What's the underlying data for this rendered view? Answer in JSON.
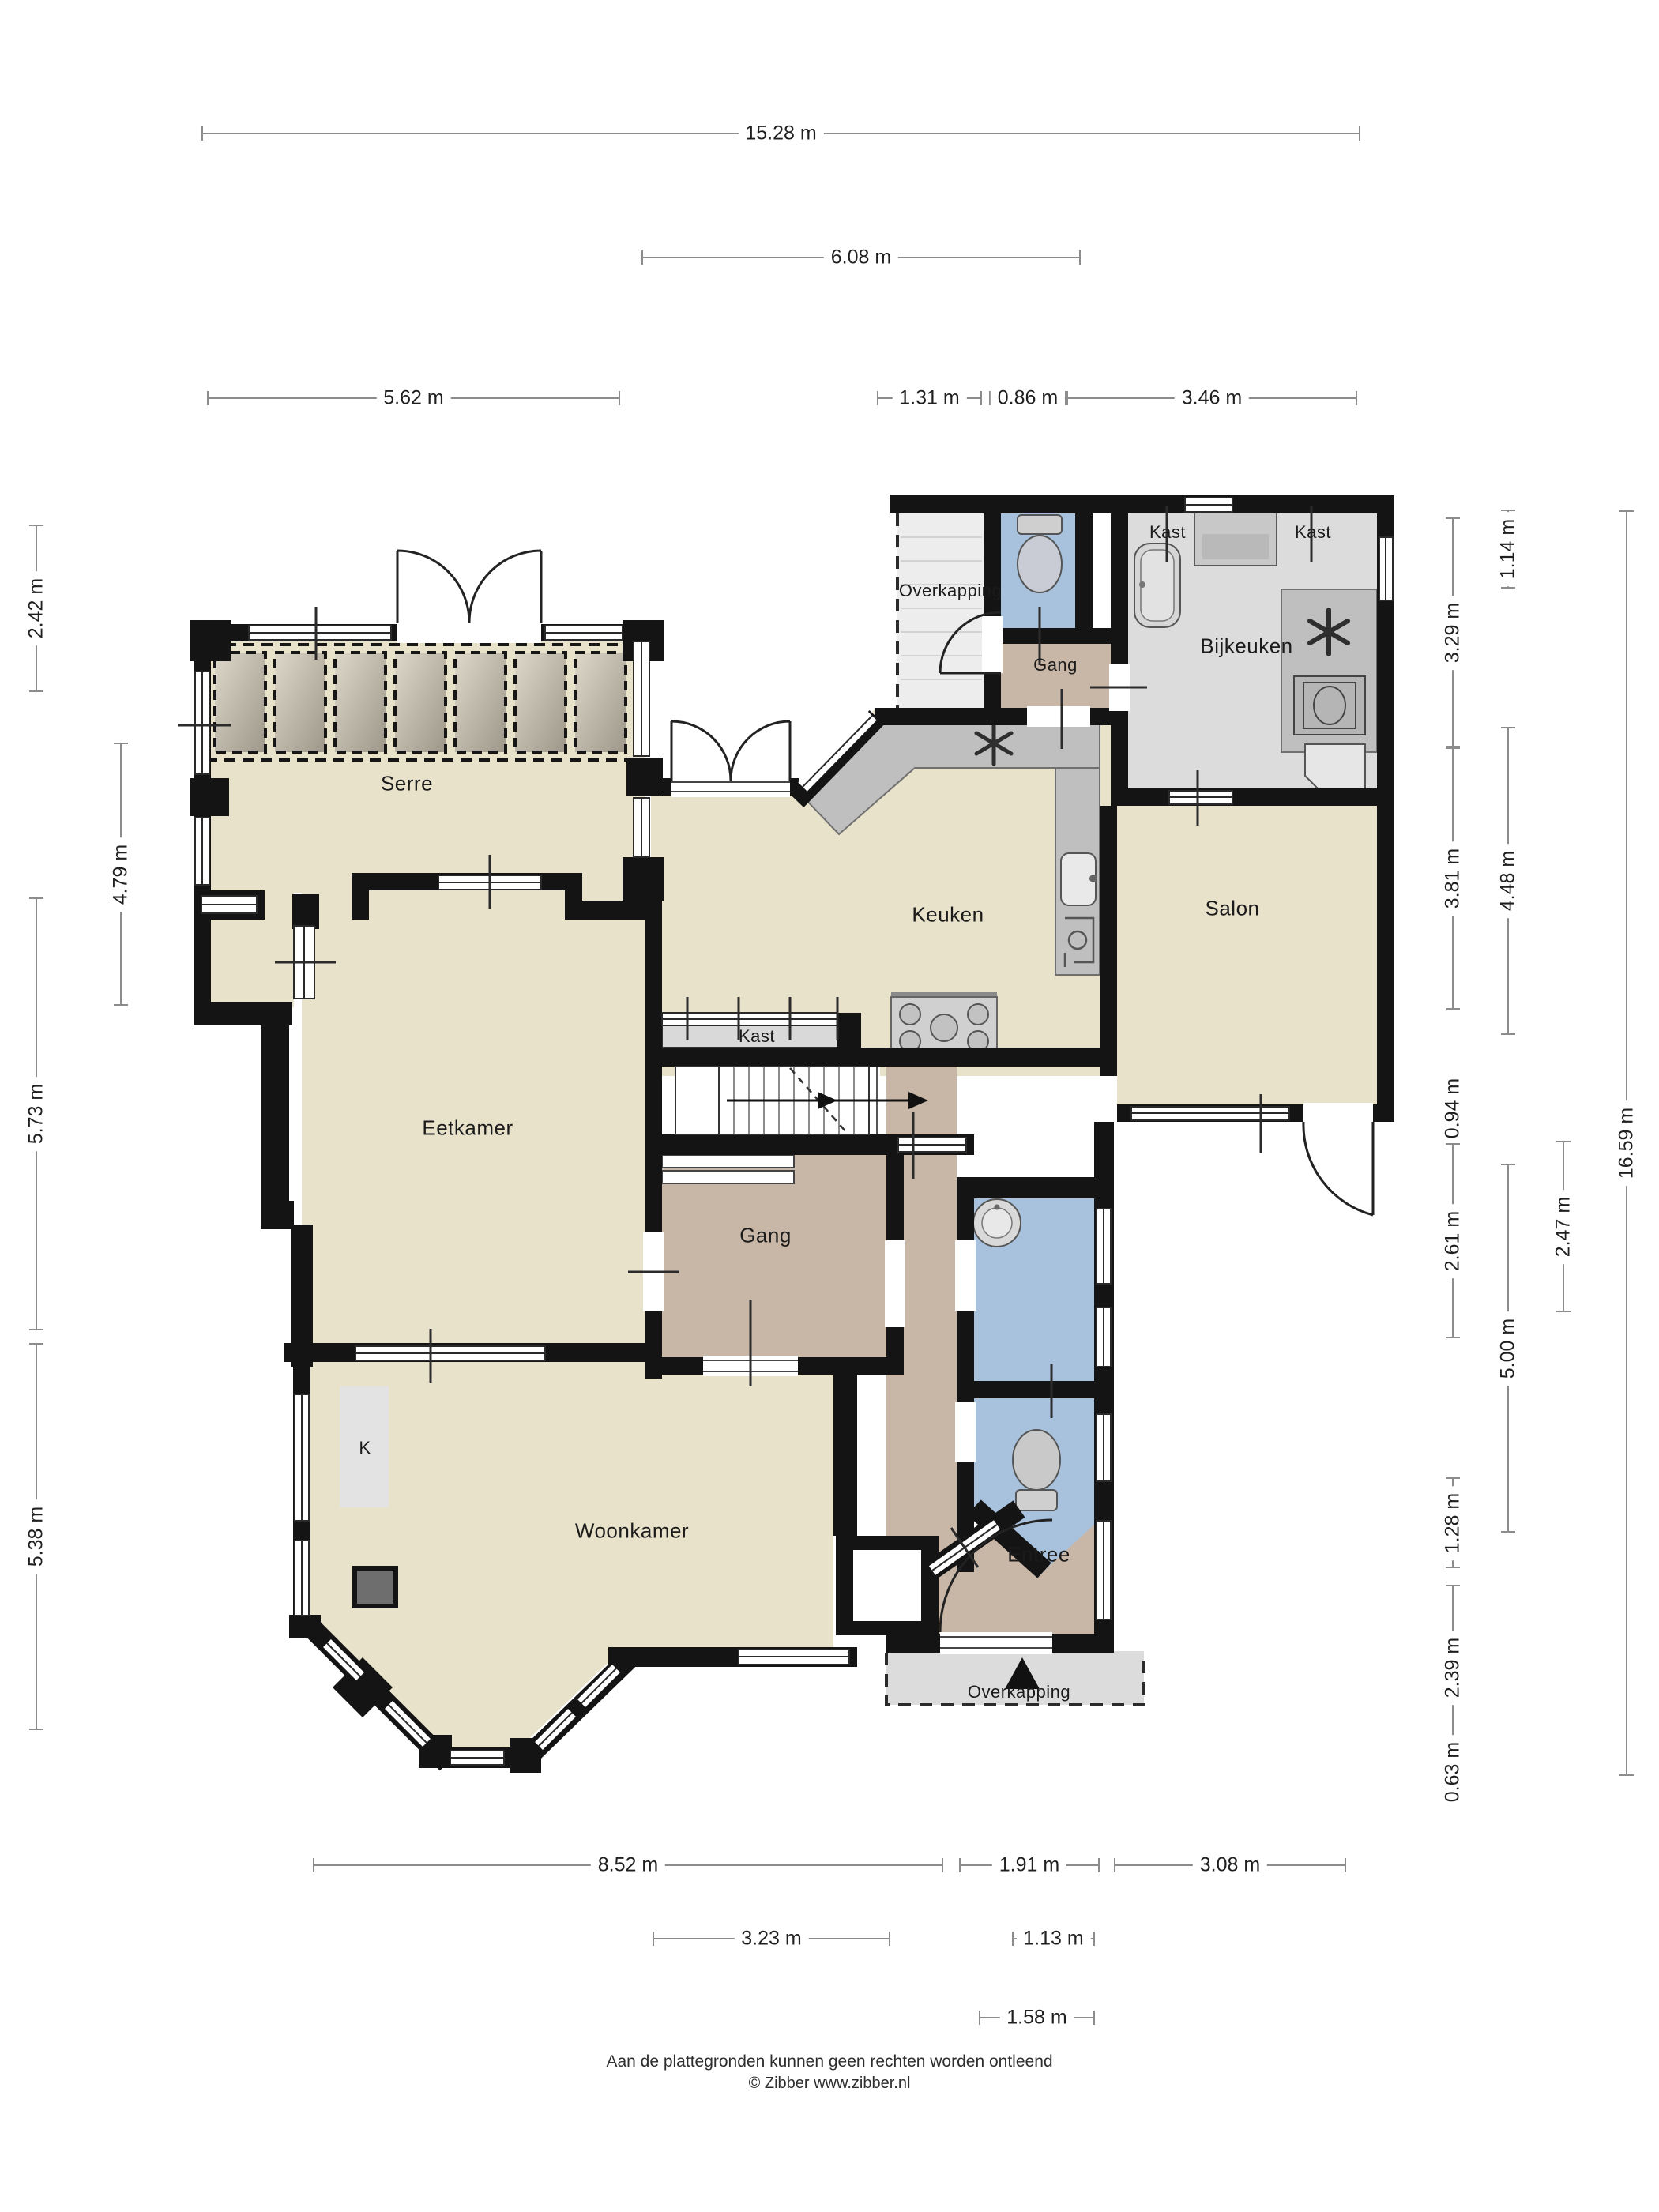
{
  "plan": {
    "rooms": {
      "serre": "Serre",
      "eetkamer": "Eetkamer",
      "woonkamer": "Woonkamer",
      "keuken": "Keuken",
      "salon": "Salon",
      "bijkeuken": "Bijkeuken",
      "gang_boven": "Gang",
      "gang_midden": "Gang",
      "entree": "Entree",
      "overkapping_boven": "Overkapping",
      "overkapping_onder": "Overkapping",
      "kast_boven_links": "Kast",
      "kast_boven_rechts": "Kast",
      "kast_midden": "Kast",
      "k_closet": "K"
    },
    "dims": {
      "top": [
        "15.28 m",
        "6.08 m",
        "5.62 m",
        "1.31 m",
        "0.86 m",
        "3.46 m"
      ],
      "left": [
        "2.42 m",
        "4.79 m",
        "5.73 m",
        "5.38 m"
      ],
      "right": [
        "3.29 m",
        "3.81 m",
        "0.94 m",
        "2.61 m",
        "1.28 m",
        "2.39 m",
        "0.63 m",
        "1.14 m",
        "4.48 m",
        "5.00 m",
        "2.47 m",
        "16.59 m"
      ],
      "bottom": [
        "8.52 m",
        "1.91 m",
        "3.08 m",
        "3.23 m",
        "1.13 m",
        "1.58 m"
      ]
    },
    "colors": {
      "floor_cream": "#e9e2cb",
      "floor_tan": "#c8b7a6",
      "floor_gray": "#dcdcdc",
      "floor_blue": "#a8c1dc",
      "wall": "#141414",
      "counter": "#bfbfbf",
      "dimension_line": "#8c8c8c"
    },
    "footer": {
      "disclaimer": "Aan de plattegronden kunnen geen rechten worden ontleend",
      "copyright": "© Zibber www.zibber.nl"
    }
  }
}
